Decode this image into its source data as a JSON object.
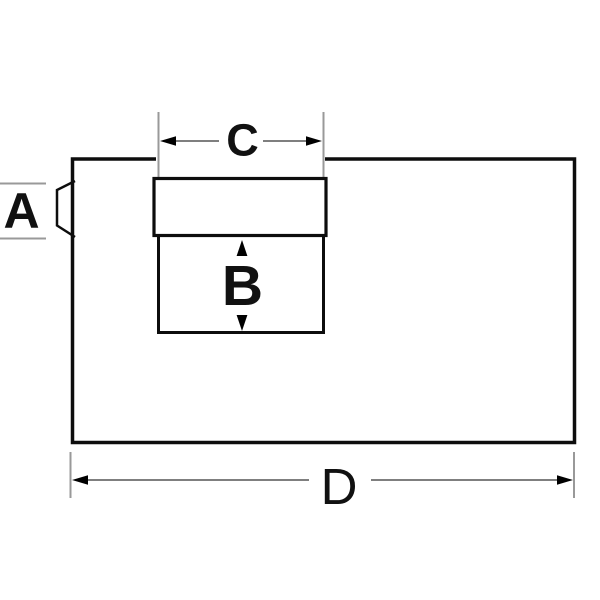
{
  "diagram": {
    "labels": {
      "a": "A",
      "b": "B",
      "c": "C",
      "d": "D"
    },
    "colors": {
      "background": "#ffffff",
      "body_outline": "#0d0d0d",
      "dimension_line": "#555555",
      "extension_line": "#999999",
      "arrowhead": "#000000",
      "shape_fill": "#ffffff"
    }
  }
}
